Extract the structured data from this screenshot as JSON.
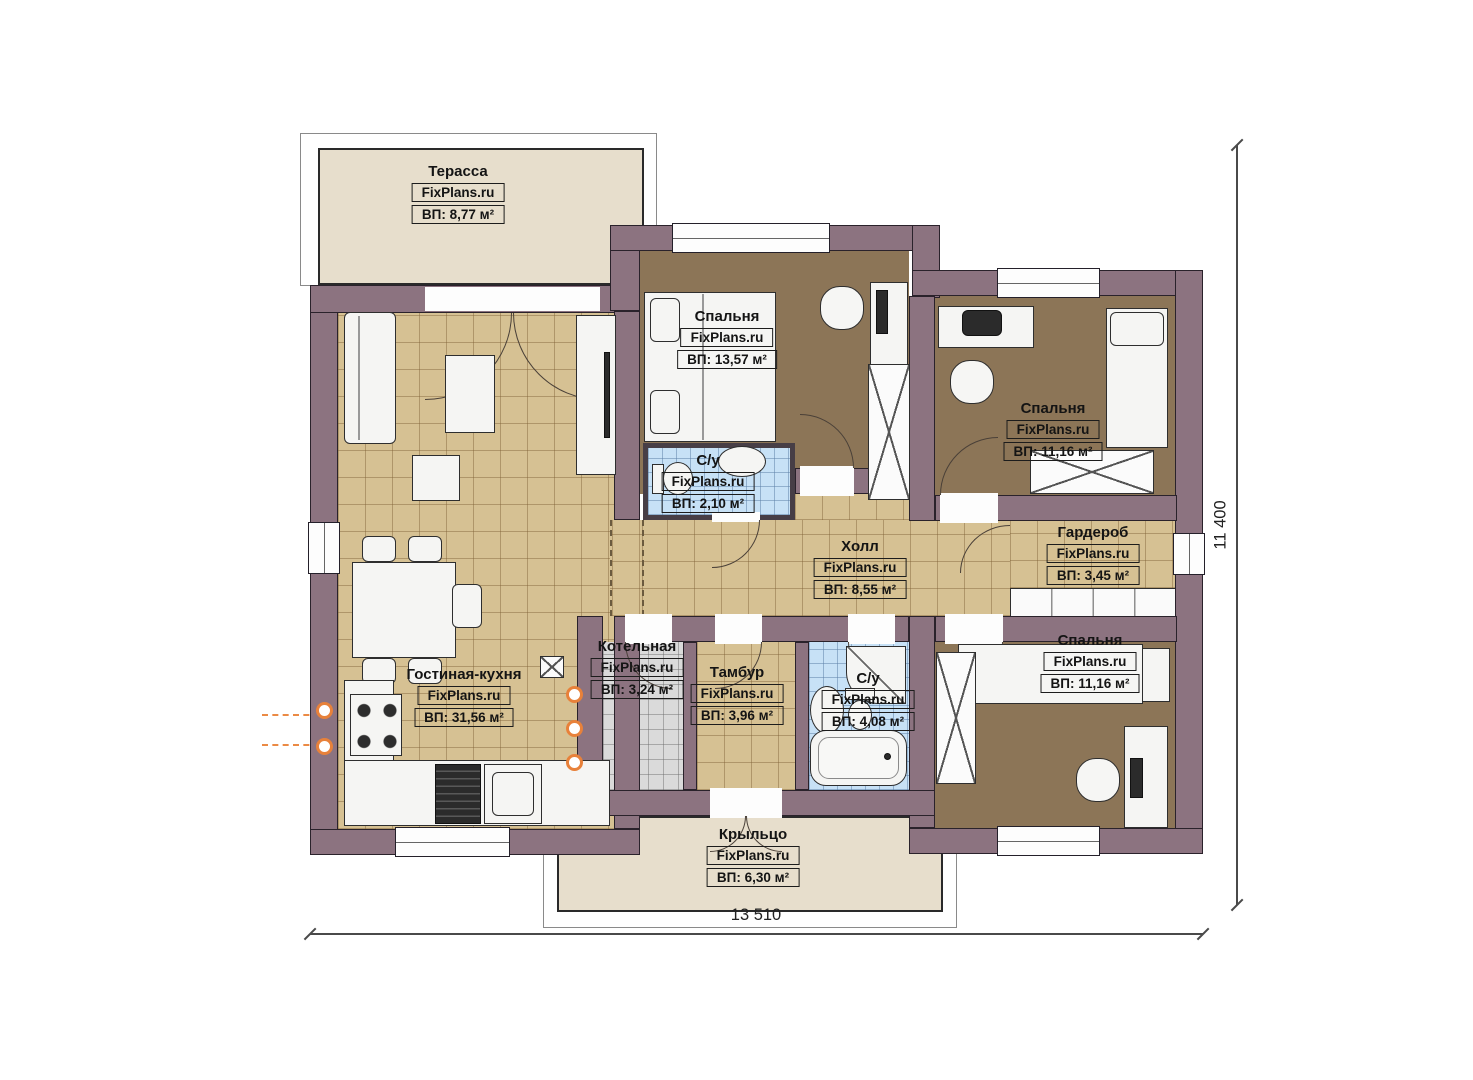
{
  "watermark": "FixPlans.ru",
  "rooms": [
    {
      "name": "Терасса",
      "watermark": "FixPlans.ru",
      "area": "ВП: 8,77 м²"
    },
    {
      "name": "Спальня",
      "watermark": "FixPlans.ru",
      "area": "ВП: 13,57 м²"
    },
    {
      "name": "Спальня",
      "watermark": "FixPlans.ru",
      "area": "ВП: 11,16 м²"
    },
    {
      "name": "С/у",
      "watermark": "FixPlans.ru",
      "area": "ВП: 2,10 м²"
    },
    {
      "name": "Холл",
      "watermark": "FixPlans.ru",
      "area": "ВП: 8,55 м²"
    },
    {
      "name": "Гардероб",
      "watermark": "FixPlans.ru",
      "area": "ВП: 3,45 м²"
    },
    {
      "name": "Котельная",
      "watermark": "FixPlans.ru",
      "area": "ВП: 3,24 м²"
    },
    {
      "name": "Тамбур",
      "watermark": "FixPlans.ru",
      "area": "ВП: 3,96 м²"
    },
    {
      "name": "С/у",
      "watermark": "FixPlans.ru",
      "area": "ВП: 4,08 м²"
    },
    {
      "name": "Спальня",
      "watermark": "FixPlans.ru",
      "area": "ВП: 11,16 м²"
    },
    {
      "name": "Гостиная-кухня",
      "watermark": "FixPlans.ru",
      "area": "ВП: 31,56 м²"
    },
    {
      "name": "Крыльцо",
      "watermark": "FixPlans.ru",
      "area": "ВП: 6,30 м²"
    }
  ],
  "dimensions": {
    "width": "13 510",
    "height": "11 400"
  },
  "colors": {
    "wall": "#8c7380",
    "floor_tan": "#d6c193",
    "floor_brown": "#8c7557",
    "tile_blue": "#c7e1f6",
    "tile_gray": "#dadada",
    "terrace_beige": "#e7decc",
    "radiator_orange": "#e8813a"
  }
}
